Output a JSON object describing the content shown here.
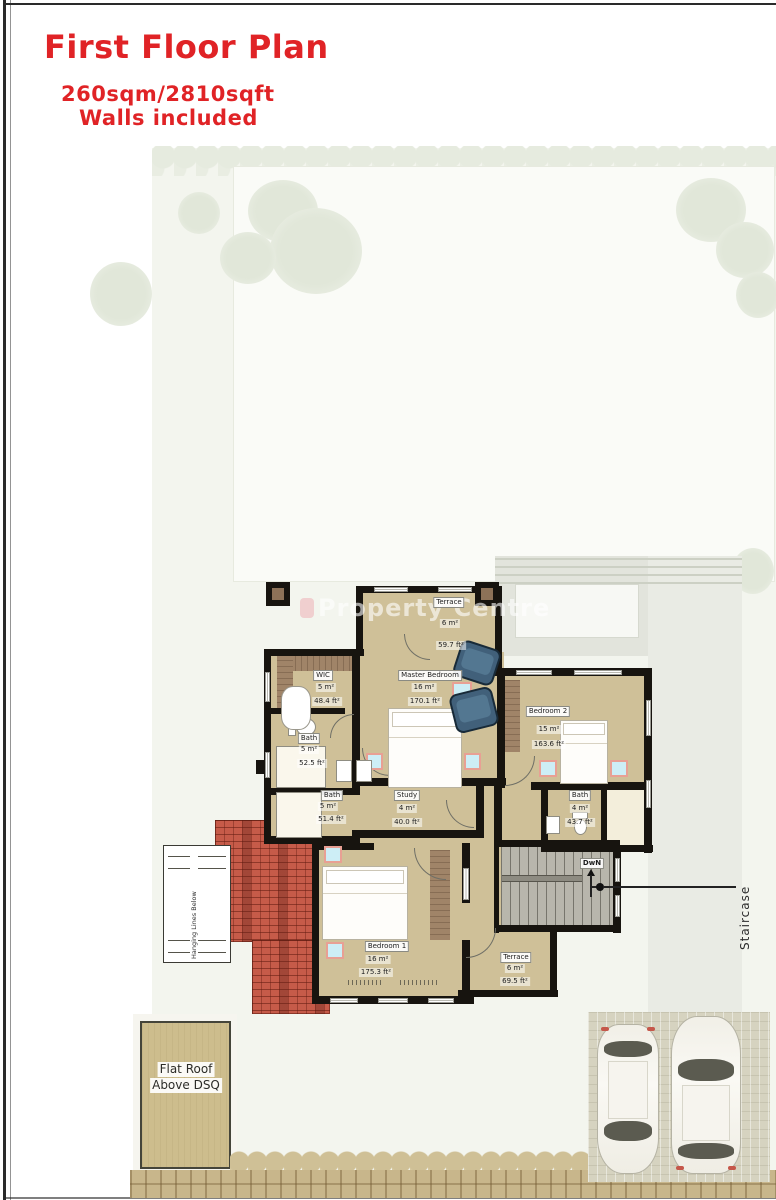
{
  "page": {
    "title": "First Floor Plan",
    "subtitle": "260sqm/2810sqft",
    "note": "Walls included"
  },
  "watermark": {
    "text": "Property Centre"
  },
  "plan": {
    "rooms": [
      {
        "key": "terrace-upper",
        "name": "Terrace",
        "area_sqm": "6 m²",
        "area_sqft": "59.7 ft²"
      },
      {
        "key": "wic",
        "name": "WIC",
        "area_sqm": "5 m²",
        "area_sqft": "48.4 ft²"
      },
      {
        "key": "master-bedroom",
        "name": "Master Bedroom",
        "area_sqm": "16 m²",
        "area_sqft": "170.1 ft²"
      },
      {
        "key": "bedroom-2",
        "name": "Bedroom 2",
        "area_sqm": "15 m²",
        "area_sqft": "163.6 ft²"
      },
      {
        "key": "bath-master",
        "name": "Bath",
        "area_sqm": "5 m²",
        "area_sqft": "52.5 ft²"
      },
      {
        "key": "bath-shared",
        "name": "Bath",
        "area_sqm": "5 m²",
        "area_sqft": "51.4 ft²"
      },
      {
        "key": "study",
        "name": "Study",
        "area_sqm": "4 m²",
        "area_sqft": "40.0 ft²"
      },
      {
        "key": "bath-2",
        "name": "Bath",
        "area_sqm": "4 m²",
        "area_sqft": "43.7 ft²"
      },
      {
        "key": "bedroom-1",
        "name": "Bedroom 1",
        "area_sqm": "16 m²",
        "area_sqft": "175.3 ft²"
      },
      {
        "key": "terrace-lower",
        "name": "Terrace",
        "area_sqm": "6 m²",
        "area_sqft": "69.5 ft²"
      }
    ],
    "stairs": {
      "direction_label": "DwN",
      "callout": "Staircase"
    },
    "annotations": {
      "hanging_lines": "Hanging Lines Below",
      "flat_roof_line1": "Flat Roof",
      "flat_roof_line2": "Above DSQ"
    }
  },
  "colors": {
    "accent_red": "#e02326",
    "wall": "#17140f",
    "floor_tan": "#cfc098",
    "roof_red": "#c65b49",
    "stair_gray": "#b8b6ac",
    "garden": "#f3f5ee"
  }
}
